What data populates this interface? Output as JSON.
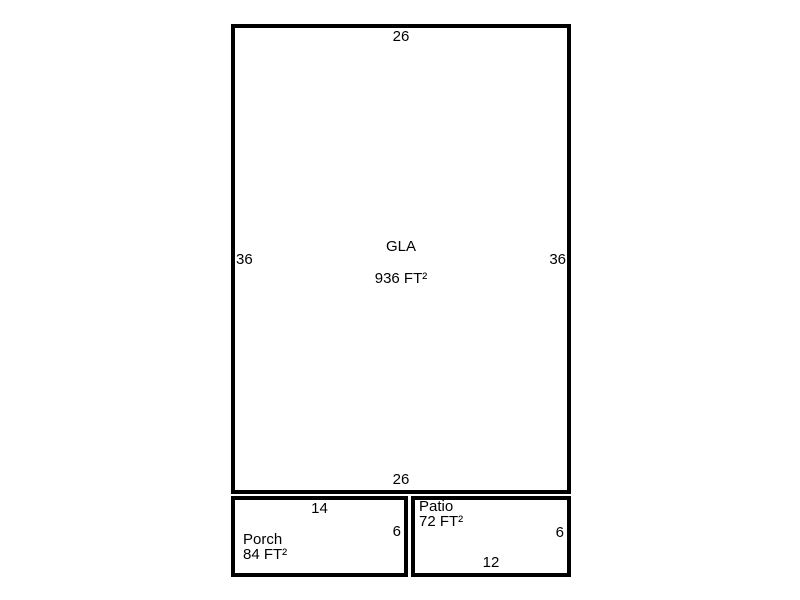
{
  "sketch": {
    "gla": {
      "label": "GLA",
      "area": "936 FT²",
      "dim_top": "26",
      "dim_bottom": "26",
      "dim_left": "36",
      "dim_right": "36"
    },
    "porch": {
      "label": "Porch",
      "area": "84 FT²",
      "dim_top": "14",
      "dim_right": "6"
    },
    "patio": {
      "label": "Patio",
      "area": "72 FT²",
      "dim_right": "6",
      "dim_bottom": "12"
    },
    "colors": {
      "line": "#000000",
      "background": "#ffffff",
      "text": "#000000"
    }
  }
}
